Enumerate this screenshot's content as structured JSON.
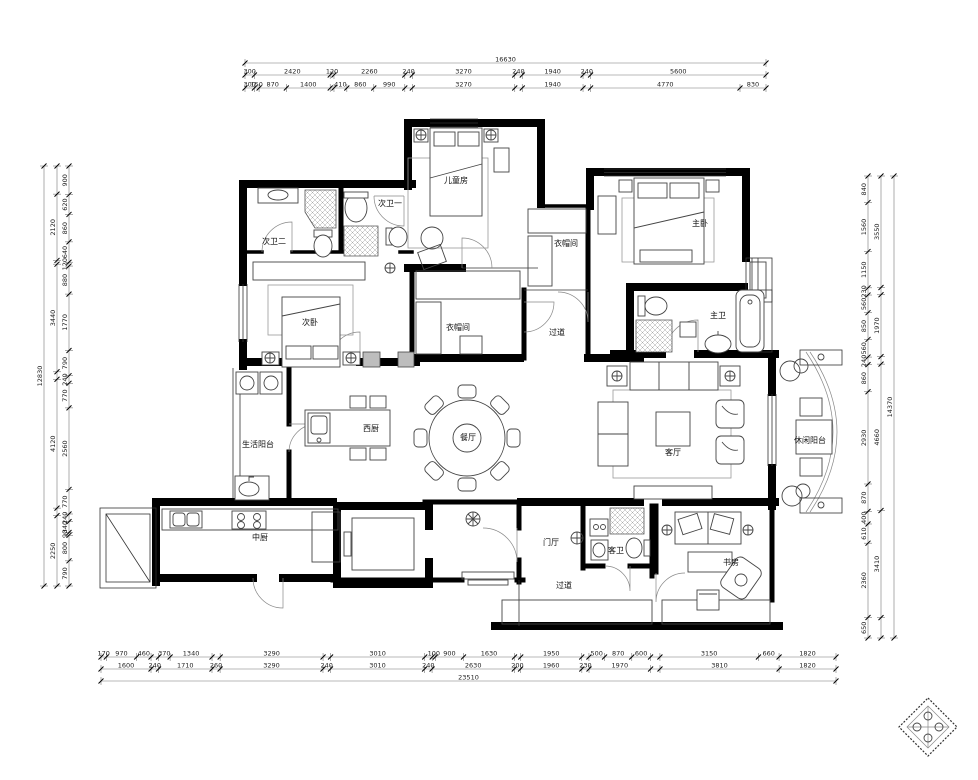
{
  "drawing": {
    "type": "apartment-floor-plan",
    "units": "mm",
    "accent_color": "#000000",
    "paper_color": "#ffffff"
  },
  "rooms": [
    {
      "id": "kids-room",
      "name": "儿童房",
      "x": 456,
      "y": 183
    },
    {
      "id": "bath-two",
      "name": "次卫二",
      "x": 274,
      "y": 244
    },
    {
      "id": "bath-one",
      "name": "次卫一",
      "x": 390,
      "y": 206
    },
    {
      "id": "second-bedroom",
      "name": "次卧",
      "x": 310,
      "y": 325
    },
    {
      "id": "closet-master",
      "name": "衣帽间",
      "x": 566,
      "y": 246
    },
    {
      "id": "master-bedroom",
      "name": "主卧",
      "x": 700,
      "y": 226
    },
    {
      "id": "walk-in-closet",
      "name": "衣帽间",
      "x": 458,
      "y": 330
    },
    {
      "id": "hallway-middle",
      "name": "过道",
      "x": 557,
      "y": 335
    },
    {
      "id": "master-bath",
      "name": "主卫",
      "x": 718,
      "y": 318
    },
    {
      "id": "service-balcony",
      "name": "生活阳台",
      "x": 258,
      "y": 447
    },
    {
      "id": "west-kitchen",
      "name": "西厨",
      "x": 371,
      "y": 431
    },
    {
      "id": "dining-room",
      "name": "餐厅",
      "x": 468,
      "y": 440
    },
    {
      "id": "living-room",
      "name": "客厅",
      "x": 673,
      "y": 455
    },
    {
      "id": "leisure-balcony",
      "name": "休闲阳台",
      "x": 810,
      "y": 443
    },
    {
      "id": "chinese-kitchen",
      "name": "中厨",
      "x": 260,
      "y": 540
    },
    {
      "id": "foyer",
      "name": "门厅",
      "x": 551,
      "y": 545
    },
    {
      "id": "guest-bath",
      "name": "客卫",
      "x": 616,
      "y": 553
    },
    {
      "id": "study",
      "name": "书房",
      "x": 731,
      "y": 565
    },
    {
      "id": "hallway-bottom",
      "name": "过道",
      "x": 564,
      "y": 588
    }
  ],
  "dimensions": [
    {
      "orient": "h",
      "x0": 245,
      "x1": 766,
      "rows": [
        {
          "pos": 63,
          "segs": [
            [
              16630,
              "16630"
            ]
          ]
        },
        {
          "pos": 75,
          "segs": [
            [
              300,
              "300"
            ],
            [
              2420,
              "2420"
            ],
            [
              120,
              "120"
            ],
            [
              2260,
              "2260"
            ],
            [
              240,
              "240"
            ],
            [
              3270,
              "3270"
            ],
            [
              240,
              "240"
            ],
            [
              1940,
              "1940"
            ],
            [
              240,
              "240"
            ],
            [
              5600,
              "5600"
            ]
          ]
        },
        {
          "pos": 88,
          "segs": [
            [
              300,
              "300"
            ],
            [
              150,
              "150"
            ],
            [
              870,
              "870"
            ],
            [
              1400,
              "1400"
            ],
            [
              120,
              ""
            ],
            [
              410,
              "410"
            ],
            [
              860,
              "860"
            ],
            [
              990,
              "990"
            ],
            [
              240,
              ""
            ],
            [
              3270,
              "3270"
            ],
            [
              240,
              ""
            ],
            [
              1940,
              "1940"
            ],
            [
              240,
              ""
            ],
            [
              4770,
              "4770"
            ],
            [
              830,
              "830"
            ]
          ]
        }
      ]
    },
    {
      "orient": "h",
      "x0": 101,
      "x1": 836,
      "rows": [
        {
          "pos": 657,
          "segs": [
            [
              170,
              "170"
            ],
            [
              970,
              "970"
            ],
            [
              460,
              "460"
            ],
            [
              240,
              ""
            ],
            [
              370,
              "370"
            ],
            [
              1340,
              "1340"
            ],
            [
              260,
              ""
            ],
            [
              3290,
              "3290"
            ],
            [
              240,
              ""
            ],
            [
              3010,
              "3010"
            ],
            [
              240,
              ""
            ],
            [
              100,
              "100"
            ],
            [
              900,
              "900"
            ],
            [
              1630,
              "1630"
            ],
            [
              200,
              ""
            ],
            [
              1950,
              "1950"
            ],
            [
              230,
              ""
            ],
            [
              500,
              "500"
            ],
            [
              870,
              "870"
            ],
            [
              600,
              "600"
            ],
            [
              300,
              ""
            ],
            [
              3150,
              "3150"
            ],
            [
              660,
              "660"
            ],
            [
              1820,
              "1820"
            ]
          ]
        },
        {
          "pos": 669,
          "segs": [
            [
              1600,
              "1600"
            ],
            [
              240,
              "240"
            ],
            [
              1710,
              "1710"
            ],
            [
              260,
              "260"
            ],
            [
              3290,
              "3290"
            ],
            [
              240,
              "240"
            ],
            [
              3010,
              "3010"
            ],
            [
              240,
              "240"
            ],
            [
              2630,
              "2630"
            ],
            [
              200,
              "200"
            ],
            [
              1960,
              "1960"
            ],
            [
              230,
              "230"
            ],
            [
              1970,
              "1970"
            ],
            [
              300,
              ""
            ],
            [
              3810,
              "3810"
            ],
            [
              1820,
              "1820"
            ]
          ]
        },
        {
          "pos": 681,
          "segs": [
            [
              23510,
              "23510"
            ]
          ]
        }
      ]
    },
    {
      "orient": "v",
      "y0": 166,
      "y1": 586,
      "rows": [
        {
          "pos": 44,
          "segs": [
            [
              12830,
              "12830"
            ]
          ]
        },
        {
          "pos": 57,
          "segs": [
            [
              900,
              ""
            ],
            [
              2120,
              "2120"
            ],
            [
              120,
              ""
            ],
            [
              3440,
              "3440"
            ],
            [
              240,
              ""
            ],
            [
              4120,
              "4120"
            ],
            [
              240,
              ""
            ],
            [
              2250,
              "2250"
            ]
          ]
        },
        {
          "pos": 69,
          "segs": [
            [
              900,
              "900"
            ],
            [
              620,
              "620"
            ],
            [
              860,
              "860"
            ],
            [
              640,
              "640"
            ],
            [
              120,
              "120"
            ],
            [
              880,
              "880"
            ],
            [
              1770,
              "1770"
            ],
            [
              790,
              "790"
            ],
            [
              240,
              "240"
            ],
            [
              770,
              "770"
            ],
            [
              2560,
              "2560"
            ],
            [
              770,
              "770"
            ],
            [
              240,
              "240"
            ],
            [
              340,
              "340"
            ],
            [
              90,
              "90"
            ],
            [
              800,
              "800"
            ],
            [
              790,
              "790"
            ]
          ]
        }
      ]
    },
    {
      "orient": "v",
      "y0": 176,
      "y1": 638,
      "rows": [
        {
          "pos": 868,
          "segs": [
            [
              840,
              "840"
            ],
            [
              1560,
              "1560"
            ],
            [
              1150,
              "1150"
            ],
            [
              230,
              "230"
            ],
            [
              560,
              "560"
            ],
            [
              850,
              "850"
            ],
            [
              560,
              "560"
            ],
            [
              240,
              "240"
            ],
            [
              860,
              "860"
            ],
            [
              2930,
              "2930"
            ],
            [
              870,
              "870"
            ],
            [
              400,
              "400"
            ],
            [
              610,
              "610"
            ],
            [
              2360,
              "2360"
            ],
            [
              650,
              "650"
            ]
          ]
        },
        {
          "pos": 881,
          "segs": [
            [
              3550,
              "3550"
            ],
            [
              230,
              ""
            ],
            [
              1970,
              "1970"
            ],
            [
              240,
              ""
            ],
            [
              4660,
              "4660"
            ],
            [
              3410,
              "3410"
            ],
            [
              650,
              ""
            ]
          ]
        },
        {
          "pos": 894,
          "segs": [
            [
              14370,
              "14370"
            ]
          ]
        }
      ]
    }
  ]
}
